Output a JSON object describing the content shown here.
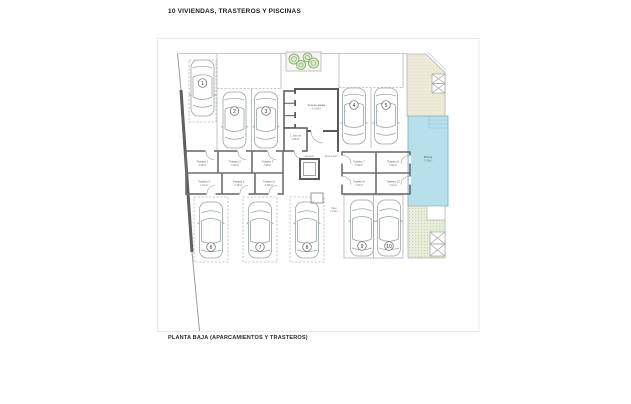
{
  "header": {
    "title": "10 VIVIENDAS, TRASTEROS Y PISCINAS"
  },
  "footer": {
    "caption": "PLANTA BAJA (APARCAMIENTOS Y TRASTEROS)"
  },
  "plan": {
    "parking": {
      "spaces": [
        "1",
        "2",
        "3",
        "4",
        "5",
        "6",
        "7",
        "8",
        "9",
        "10"
      ]
    },
    "trasteros": [
      {
        "name": "Trastero 1",
        "area": "4.65m2"
      },
      {
        "name": "Trastero 2",
        "area": "4.40m2"
      },
      {
        "name": "Trastero 3",
        "area": "3.95m2"
      },
      {
        "name": "Trastero 4",
        "area": "3.10m2"
      },
      {
        "name": "Trastero 5",
        "area": "2.95m2"
      },
      {
        "name": "Trastero 6",
        "area": "2.60m2"
      },
      {
        "name": "Trastero 7",
        "area": "5.85m2"
      },
      {
        "name": "Trastero 8",
        "area": "5.60m2"
      },
      {
        "name": "Trastero 9",
        "area": "4.25m2"
      },
      {
        "name": "Trastero 10",
        "area": "4.10m2"
      }
    ],
    "rooms": {
      "access": {
        "label": "Acceso garaje",
        "area": "14.50m2"
      },
      "waste": {
        "label": "C. basuras",
        "area": "1.80m2"
      },
      "elevator": {
        "label": "Ascensor"
      },
      "hall": {
        "label": "Zona común"
      },
      "passage1": {
        "label": "Paso"
      },
      "passage2": {
        "label": "común"
      }
    },
    "pool": {
      "label": "Piscina",
      "area": "17.68m2"
    },
    "colors": {
      "pool_fill": "#b7e0eb",
      "terrace_fill": "#edead8",
      "garden_fill": "#e6edd9",
      "tree": "#7aa55a",
      "wall": "#5a5a5a"
    }
  }
}
